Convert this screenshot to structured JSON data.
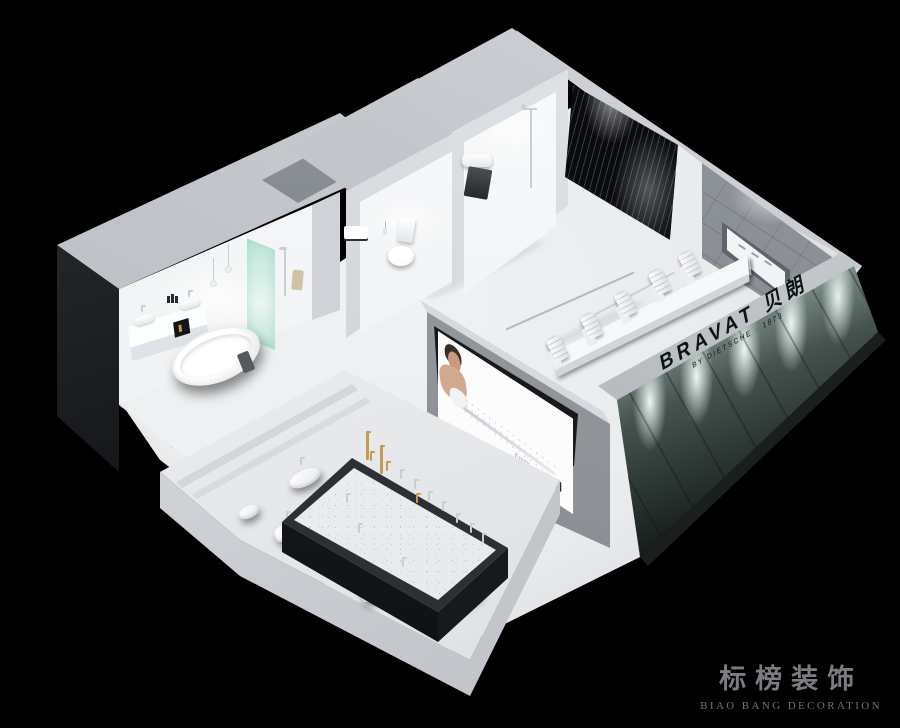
{
  "brand_wall": {
    "title": "BRAVAT 贝朗",
    "subtitle": "BY DIETSCHE · 1873"
  },
  "screen": {
    "tagline": "Enjoy"
  },
  "watermark": {
    "title_cn": "标榜装饰",
    "title_en": "BIAO BANG DECORATION"
  },
  "colors": {
    "bg": "#000000",
    "marble": "#e9ebed",
    "dark_face": "#0a0b0d",
    "glass_green": "#bfe8d6",
    "tile": "#787d84",
    "chrome": "#c9ced4",
    "gold": "#c49b52",
    "panel_light": "#e4f2ec",
    "panel_dark": "#101715",
    "screen_skin": "#c99a80",
    "watermark": "#797c81"
  }
}
